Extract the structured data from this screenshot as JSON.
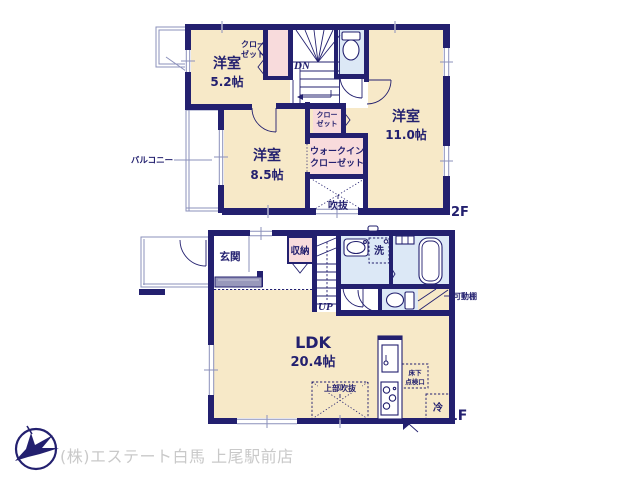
{
  "colors": {
    "wall": "#23206f",
    "room_cream": "#f7e9c8",
    "closet_pink": "#f8dbdc",
    "wet_blue": "#dce8f6",
    "step_gray": "#9898bb",
    "text_navy": "#23206f",
    "footer_gray": "#c9c9c9"
  },
  "floor2": {
    "floor_label": "2F",
    "room_52": {
      "name": "洋室",
      "size": "5.2帖"
    },
    "room_110": {
      "name": "洋室",
      "size": "11.0帖"
    },
    "room_85": {
      "name": "洋室",
      "size": "8.5帖"
    },
    "closet_upper": {
      "line1": "クロー",
      "line2": "ゼット"
    },
    "closet_mid": {
      "line1": "クロー",
      "line2": "ゼット"
    },
    "wic": {
      "line1": "ウォークイン",
      "line2": "クローゼット"
    },
    "void": "吹抜",
    "stairs_down": "DN",
    "balcony": "バルコニー"
  },
  "floor1": {
    "floor_label": "1F",
    "entrance": "玄関",
    "storage": "収納",
    "wash": "洗",
    "stairs_up": "UP",
    "ldk": {
      "name": "LDK",
      "size": "20.4帖"
    },
    "movable_shelf": "可動棚",
    "upper_void": "上部吹抜",
    "underfloor": {
      "line1": "床下",
      "line2": "点検口"
    },
    "fridge": "冷"
  },
  "footer": {
    "company": "(株)エステート白馬 上尾駅前店"
  }
}
